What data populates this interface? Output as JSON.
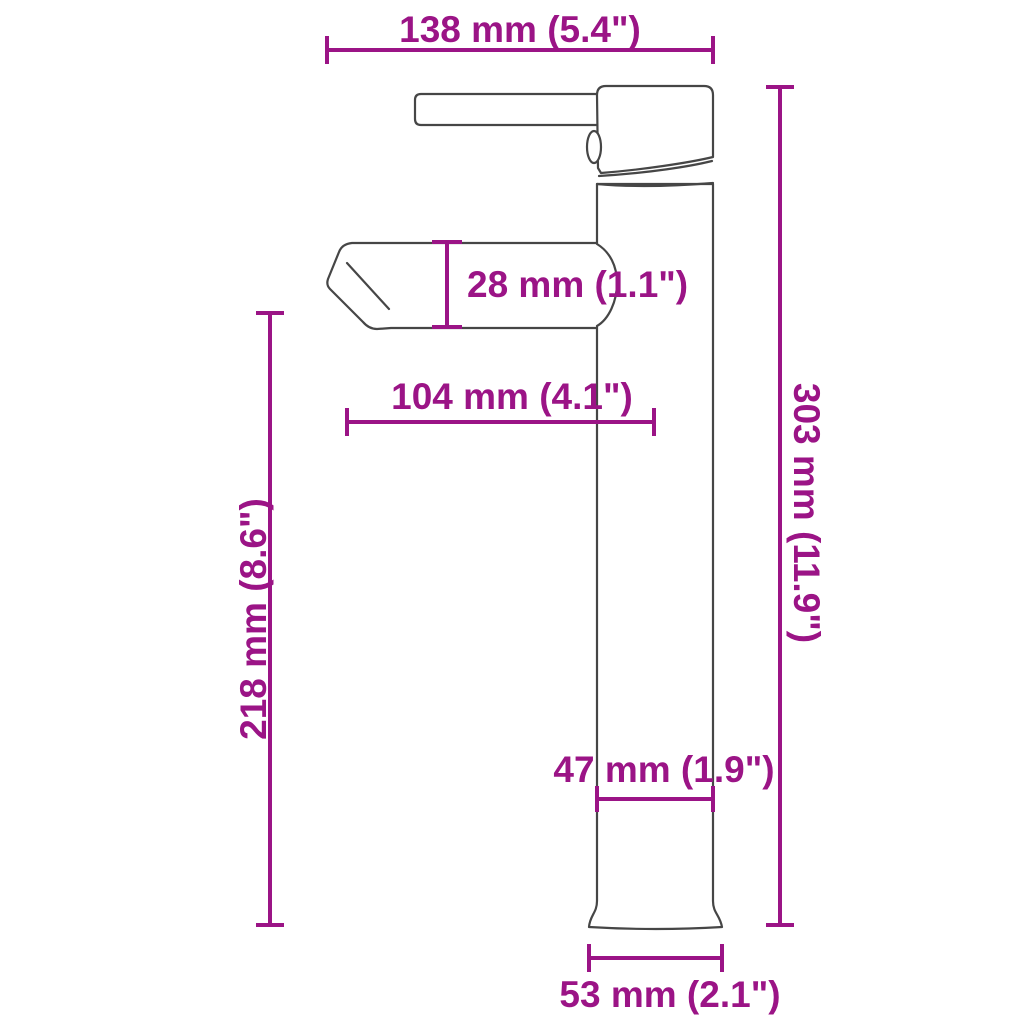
{
  "diagram": {
    "type": "product-dimension-drawing",
    "subject": "tall single-lever basin faucet, side view",
    "colors": {
      "annotation": "#9B1486",
      "outline": "#464646",
      "background": "#FFFFFF"
    },
    "dimensions": {
      "overall_depth": {
        "mm": 138,
        "inches": 5.4,
        "label": "138 mm (5.4\")"
      },
      "spout_height": {
        "mm": 28,
        "inches": 1.1,
        "label": "28 mm (1.1\")"
      },
      "spout_reach": {
        "mm": 104,
        "inches": 4.1,
        "label": "104 mm (4.1\")"
      },
      "spout_clearance": {
        "mm": 218,
        "inches": 8.6,
        "label": "218 mm (8.6\")"
      },
      "total_height": {
        "mm": 303,
        "inches": 11.9,
        "label": "303 mm (11.9\")"
      },
      "body_width": {
        "mm": 47,
        "inches": 1.9,
        "label": "47 mm (1.9\")"
      },
      "base_width": {
        "mm": 53,
        "inches": 2.1,
        "label": "53 mm (2.1\")"
      }
    }
  }
}
